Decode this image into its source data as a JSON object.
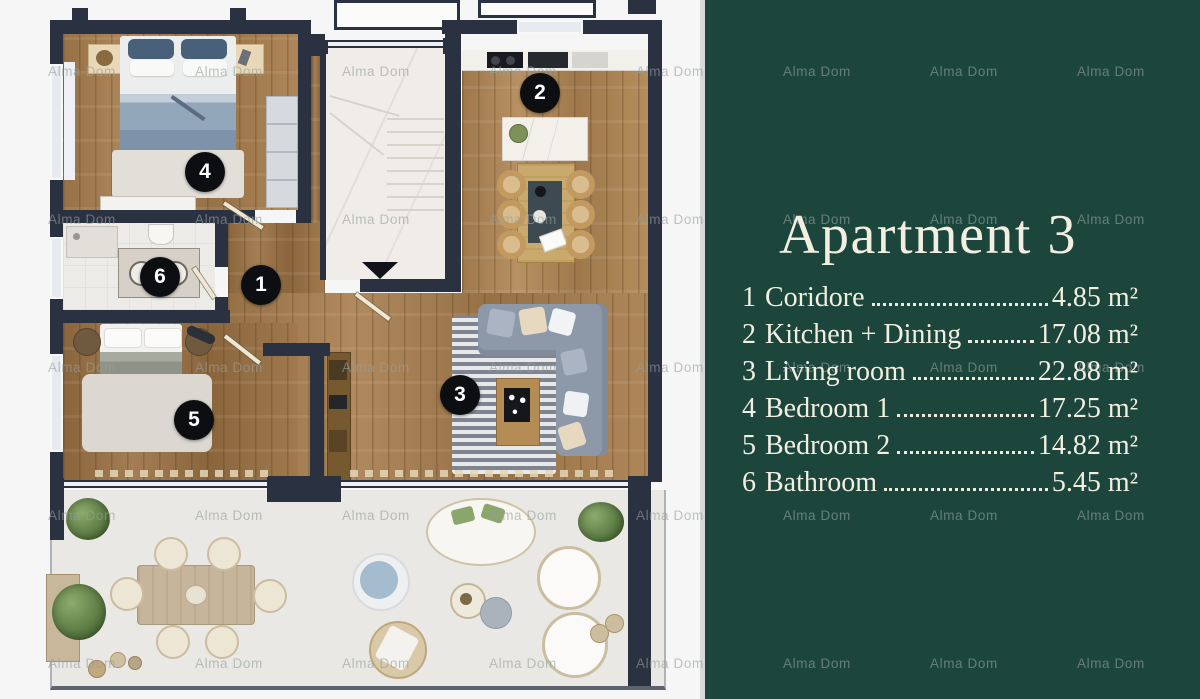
{
  "watermark": {
    "text": "Alma Dom"
  },
  "panel": {
    "title": "Apartment 3",
    "rooms": [
      {
        "num": "1",
        "label": "Coridore",
        "area": "4.85 m²"
      },
      {
        "num": "2",
        "label": "Kitchen + Dining",
        "area": "17.08 m²"
      },
      {
        "num": "3",
        "label": "Living room",
        "area": "22.88 m²"
      },
      {
        "num": "4",
        "label": "Bedroom 1",
        "area": "17.25 m²"
      },
      {
        "num": "5",
        "label": "Bedroom 2",
        "area": "14.82 m²"
      },
      {
        "num": "6",
        "label": "Bathroom",
        "area": "5.45 m²"
      }
    ]
  },
  "colors": {
    "panel_bg": "#1c463c",
    "panel_text": "#f2eee1",
    "wall": "#2a3140",
    "badge_bg": "#0c0e12",
    "wood_floor": "#a87e4e"
  }
}
